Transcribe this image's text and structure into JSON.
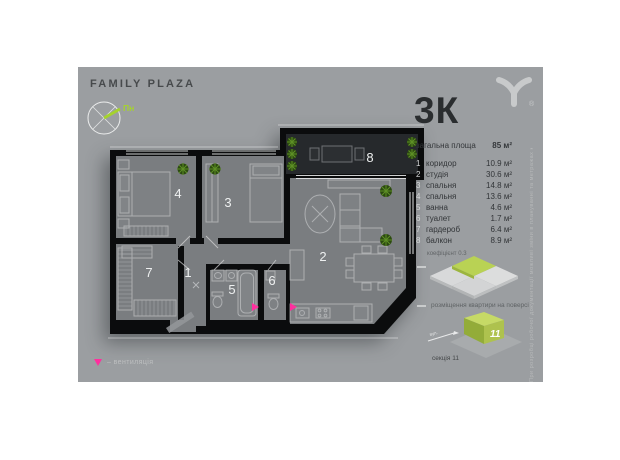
{
  "brand": {
    "name": "FAMILY PLAZA",
    "logo_icon": "y-fork-logo-icon",
    "registered_mark": "®"
  },
  "compass": {
    "icon": "compass-icon",
    "north_label": "Пн"
  },
  "apartment": {
    "type": "3К",
    "total_area_label": "загальна площа",
    "total_area_value": "85 м²",
    "coefficient_note": "коефіцієнт 0.3",
    "rooms": [
      {
        "num": "1",
        "name": "коридор",
        "area": "10.9 м²"
      },
      {
        "num": "2",
        "name": "студія",
        "area": "30.6 м²"
      },
      {
        "num": "3",
        "name": "спальня",
        "area": "14.8 м²"
      },
      {
        "num": "4",
        "name": "спальня",
        "area": "13.6 м²"
      },
      {
        "num": "5",
        "name": "ванна",
        "area": "4.6 м²"
      },
      {
        "num": "6",
        "name": "туалет",
        "area": "1.7 м²"
      },
      {
        "num": "7",
        "name": "гардероб",
        "area": "6.4 м²"
      },
      {
        "num": "8",
        "name": "балкон",
        "area": "8.9 м²"
      }
    ]
  },
  "floor_map": {
    "caption": "розміщення квартири на поверсі",
    "highlight_icon": "highlighted-apartment-tile-icon"
  },
  "section": {
    "building_number": "11",
    "label": "секція 11",
    "street_label": "вул.",
    "icon": "section-building-icon"
  },
  "legend": {
    "ventilation_symbol_icon": "pink-triangle-icon",
    "ventilation_text": "– вентиляція"
  },
  "disclaimer": "При розробці робочої документації можливі зміни в плануванні та метражах квартир",
  "colors": {
    "panel": "#9b9ea1",
    "floor": "#7a7d80",
    "walls": "#0b0c0d",
    "balcony_floor": "#26292c",
    "accent_green": "#b5cf55",
    "needle_green": "#a5d32c",
    "ventilation_pink": "#ff2f9e"
  }
}
